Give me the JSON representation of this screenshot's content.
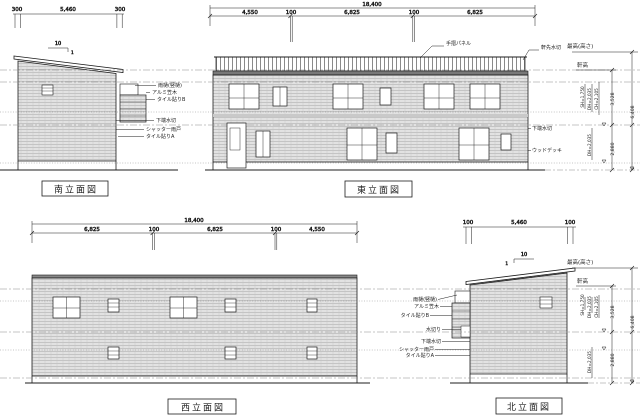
{
  "colors": {
    "line": "#1c1c1c",
    "wall_fill": "#e2e2e2",
    "wall_joint": "#a6a6a6",
    "slab": "#787878",
    "level_line": "#8a8a8a"
  },
  "south": {
    "title": "南立面図",
    "dim_left": "300",
    "dim_center": "5,460",
    "dim_right": "300",
    "slope_run": "10",
    "slope_rise": "1",
    "callouts": [
      "雨樋(竪樋)",
      "アルミ笠木",
      "タイル貼りB",
      "下端水切",
      "シャッター雨戸",
      "タイル貼りA"
    ]
  },
  "east": {
    "title": "東立面図",
    "total": "18,400",
    "segments": [
      "4,550",
      "100",
      "6,825",
      "100",
      "6,825"
    ],
    "callout_rail": "手摺パネル",
    "callout_eave": "軒先水切",
    "callout_mizukiri": "下端水切",
    "callout_deck": "ウッドデッキ"
  },
  "west": {
    "title": "西立面図",
    "total": "18,400",
    "segments": [
      "6,825",
      "100",
      "6,825",
      "100",
      "4,550"
    ]
  },
  "north": {
    "title": "北立面図",
    "dim_left": "100",
    "dim_center": "5,460",
    "dim_right": "100",
    "slope_run": "10",
    "slope_rise": "1",
    "callouts": [
      "雨樋(竪樋)",
      "アルミ笠木",
      "タイル貼りB",
      "水切り",
      "下端水切",
      "シャッター雨戸",
      "タイル貼りA"
    ]
  },
  "heights": {
    "max_label": "最高(高さ)",
    "eave_label": "軒高",
    "total": "6,408",
    "upper": "3,528",
    "lower": "2,880",
    "win1": "SH=1,750",
    "win2": "DH=2,035",
    "win3": "CH=2,105",
    "win4": "DH=2,035"
  }
}
